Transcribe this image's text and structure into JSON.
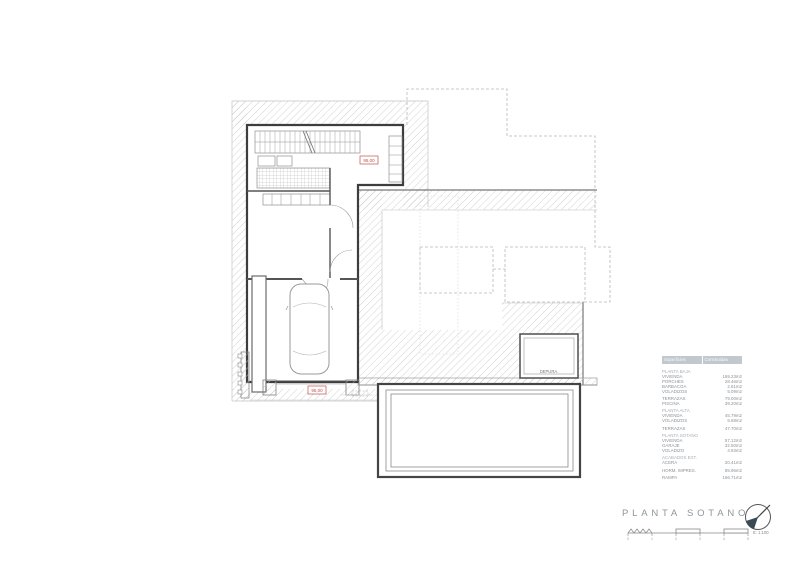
{
  "page": {
    "background": "#ffffff"
  },
  "plan": {
    "labels": {
      "depura": "DEPURA.",
      "elevation_upper": "95,00",
      "elevation_lower": "95,00"
    },
    "colors": {
      "wall": "#3d3d3d",
      "hatch_line": "#c6c6c6",
      "dashed_outline": "#b8b8b8",
      "red_label": "#c0504d"
    }
  },
  "areas_table": {
    "headers": [
      "Superficies",
      "Construidas"
    ],
    "rows": [
      {
        "type": "section",
        "label": "PLANTA BAJA"
      },
      {
        "type": "item",
        "label": "VIVIENDA",
        "value": "169.23m2"
      },
      {
        "type": "item",
        "label": "PORCHES",
        "value": "28.46m2"
      },
      {
        "type": "item",
        "label": "BARBACOA",
        "value": "2.61m2"
      },
      {
        "type": "item",
        "label": "VOLADIZOS",
        "value": "5.09m2"
      },
      {
        "type": "spacer"
      },
      {
        "type": "item",
        "label": "TERRAZAS",
        "value": "79.00m2"
      },
      {
        "type": "item",
        "label": "PISCINA",
        "value": "39.20m2"
      },
      {
        "type": "spacer"
      },
      {
        "type": "section",
        "label": "PLANTA ALTA"
      },
      {
        "type": "item",
        "label": "VIVIENDA",
        "value": "45.79m2"
      },
      {
        "type": "item",
        "label": "VOLADIZOS",
        "value": "5.68m2"
      },
      {
        "type": "spacer"
      },
      {
        "type": "item",
        "label": "TERRAZAS",
        "value": "47.70m2"
      },
      {
        "type": "spacer"
      },
      {
        "type": "section",
        "label": "PLANTA SOTANO"
      },
      {
        "type": "item",
        "label": "VIVIENDA",
        "value": "57.12m2"
      },
      {
        "type": "item",
        "label": "GARAJE",
        "value": "32.50m2"
      },
      {
        "type": "item",
        "label": "VOLADIZO",
        "value": "4.93m2"
      },
      {
        "type": "spacer"
      },
      {
        "type": "section",
        "label": "ACABADOS EXT."
      },
      {
        "type": "item",
        "label": "ACERA",
        "value": "20.41m2"
      },
      {
        "type": "spacer"
      },
      {
        "type": "item",
        "label": "HORM. IMPRES.",
        "value": "85.96m2"
      },
      {
        "type": "spacer"
      },
      {
        "type": "item",
        "label": "RAMPA",
        "value": "166.71m2"
      }
    ]
  },
  "title_block": {
    "title": "PLANTA SOTANO",
    "scale_label": "E: 1:100",
    "scale_ticks": [
      "0",
      "1",
      "2",
      "3",
      "4",
      "5"
    ],
    "north_icon": "north-arrow-icon"
  }
}
